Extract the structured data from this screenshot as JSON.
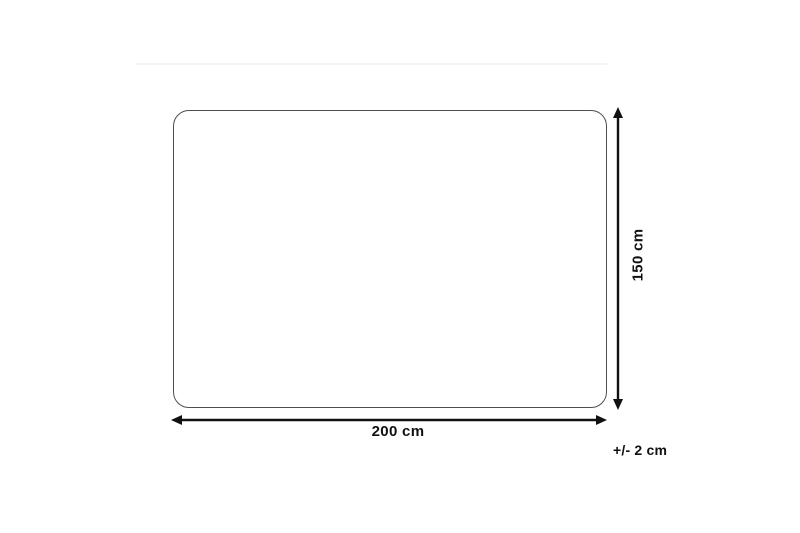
{
  "diagram": {
    "type": "product-dimension-diagram",
    "width_label": "200 cm",
    "height_label": "150 cm",
    "tolerance_label": "+/- 2 cm",
    "shape": "rounded-rectangle",
    "colors": {
      "background": "#ffffff",
      "outline": "#4f4f4f",
      "arrow": "#111111",
      "divider": "#f3f3f3"
    }
  }
}
